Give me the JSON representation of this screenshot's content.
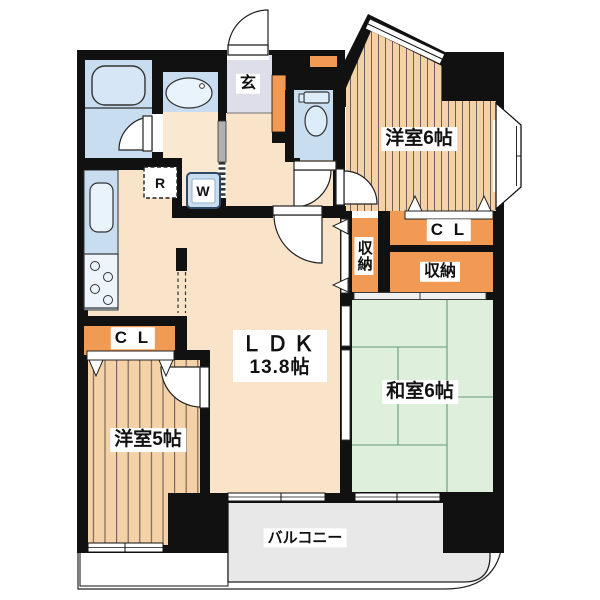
{
  "plan": {
    "type": "apartment-floor-plan",
    "rooms": {
      "ldk": {
        "label": "ＬＤＫ",
        "size": "13.8帖"
      },
      "western6": {
        "label": "洋室6帖"
      },
      "western5": {
        "label": "洋室5帖"
      },
      "japanese6": {
        "label": "和室6帖"
      },
      "entrance": {
        "label": "玄"
      },
      "balcony": {
        "label": "バルコニー"
      }
    },
    "closets": {
      "cl_western6": "C L",
      "cl_western5": "C L",
      "storage_tall": "収納",
      "storage_wide": "収納"
    },
    "appliances": {
      "refrigerator": "R",
      "washing_machine": "W"
    },
    "colors": {
      "wall": "#111111",
      "flooring_stripe_room": "#f4d1a6",
      "ldk_floor": "#fae4c9",
      "tatami": "#def0dc",
      "closet_orange": "#f09a54",
      "wet_area_blue": "#c9ddf0",
      "fixture_blue": "#e9f3fb",
      "entrance_floor": "#dedeeb",
      "balcony_gray": "#e8e8e8"
    }
  }
}
